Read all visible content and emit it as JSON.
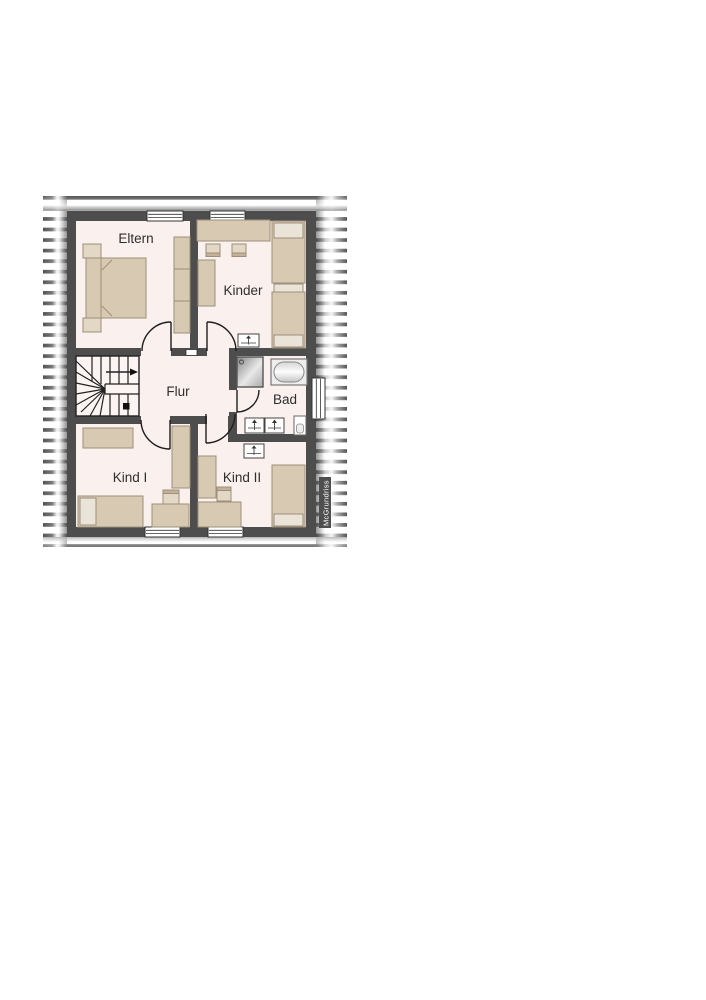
{
  "floorplan": {
    "rooms": {
      "eltern": {
        "label": "Eltern"
      },
      "kinder": {
        "label": "Kinder"
      },
      "flur": {
        "label": "Flur"
      },
      "bad": {
        "label": "Bad"
      },
      "kind1": {
        "label": "Kind I"
      },
      "kind2": {
        "label": "Kind II"
      }
    },
    "watermark": "McGrundriss",
    "colors": {
      "wall": "#4d4d4d",
      "floor": "#faf0ee",
      "furniture": "#d8c9b2",
      "furniture_light": "#eae3d7",
      "hatch_stripe": "#4b4b4b",
      "line": "#1e1e1e"
    },
    "fixtures": [
      "stairs",
      "shower",
      "bathtub",
      "washbasin",
      "washbasin",
      "toilet",
      "radiator",
      "radiator",
      "double-bed",
      "single-bed",
      "single-bed",
      "single-bed",
      "single-bed",
      "wardrobe",
      "desk",
      "chair",
      "window",
      "window",
      "window",
      "window",
      "window",
      "door",
      "door",
      "door",
      "door",
      "door"
    ]
  }
}
